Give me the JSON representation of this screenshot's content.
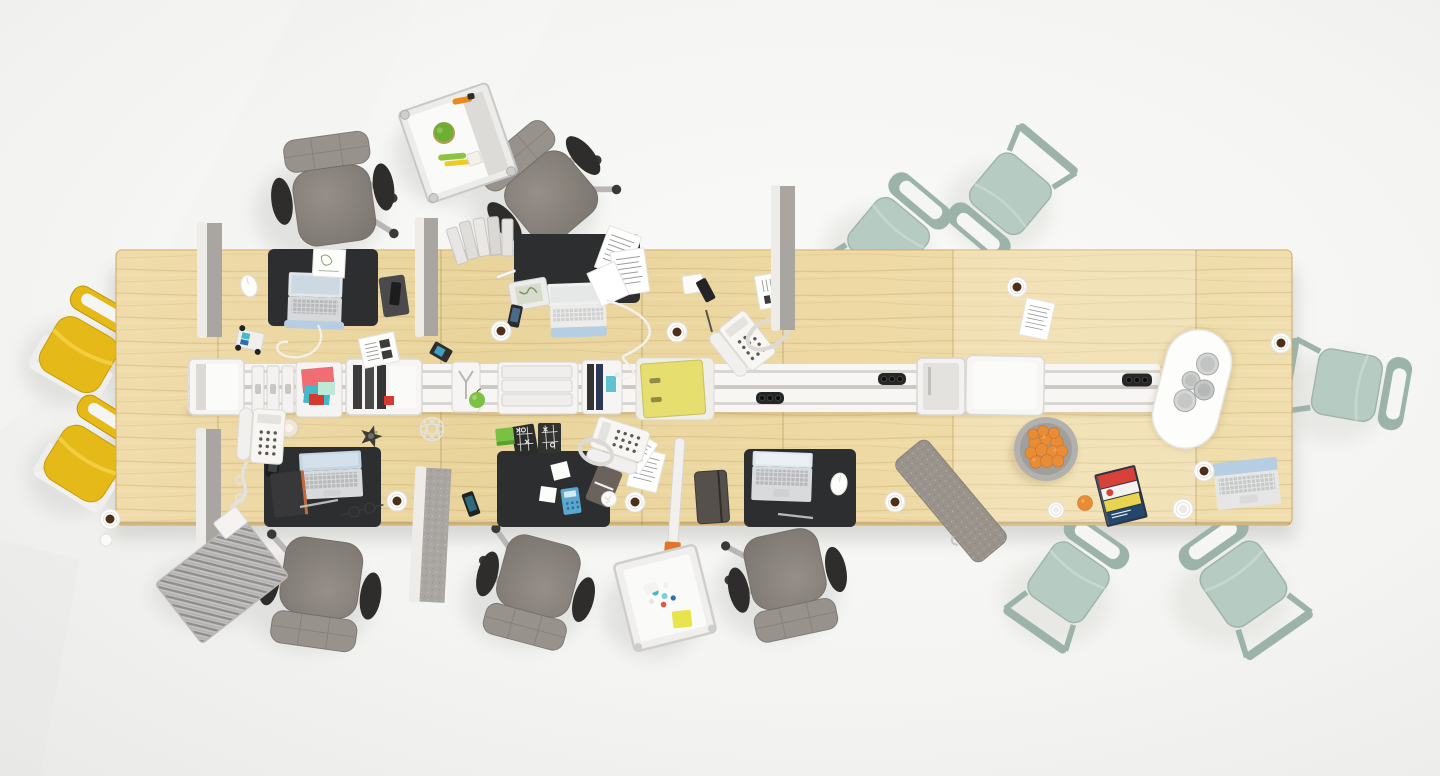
{
  "scene": {
    "description": "Top-down 3D render of a long shared office bench desk in light wood with a white central cable rail, black desk pads with open laptops, scattered papers, coffee cups, desk phones and accessories; gray task chairs, mint stacking chairs and yellow cantilever chairs stand around the desk on a white studio floor",
    "desk": {
      "label": "wood bench desk",
      "sections": 6,
      "seam_x_positions": [
        218,
        441,
        642,
        783,
        953,
        1196
      ]
    },
    "cable_rail": {
      "label": "white center cable rail",
      "power_strips": 3,
      "sockets_per_strip": 3
    },
    "desk_pads": {
      "label": "black desk pad",
      "count": 5
    },
    "laptops": {
      "label": "open laptop",
      "count": 5
    },
    "desk_phones": {
      "label": "white desk phone with coiled cord",
      "count": 3
    },
    "chairs": {
      "gray_task_chairs": 5,
      "mint_stacking_chairs": 5,
      "yellow_cantilever_chairs": 2
    },
    "dividers": {
      "label": "gray screen divider",
      "count": 5
    },
    "trolleys": {
      "label": "white utility trolley",
      "count": 2
    },
    "storage": [
      "open storage bin",
      "white ring binders",
      "paper tray with colorful sheets",
      "storage box with dark books",
      "wire organizer bin",
      "flat binder tray",
      "book box",
      "yellow lever-arch folder on tray",
      "right storage bins"
    ],
    "accessories": [
      "fruit bowl with oranges",
      "single clementine",
      "magazine stack",
      "white oval tray with glasses",
      "felt screen panel lying on desk",
      "striped mat",
      "leaning silver binders",
      "tic-tac-toe game",
      "green note block",
      "star ornament",
      "wire ball",
      "tape roll",
      "green apples",
      "eyeglasses",
      "toy truck",
      "voice recorder on notebook",
      "navigation device",
      "smartphones",
      "notebooks",
      "computer mice",
      "earbud cable",
      "paper sheets",
      "crumpled paper"
    ],
    "counts": {
      "coffee_cups": 9,
      "extra_cups": 2,
      "oranges_in_bowl": 13,
      "drinking_glasses": 4,
      "leaning_binders": 5
    }
  },
  "palette": {
    "floor": "#f5f5f3",
    "floor_dark": "#e9e9e7",
    "shadow": "#d7d6d3",
    "wood": "#ecd8a1",
    "wood_light": "#f3e3b4",
    "wood_line": "#b98f4a",
    "pad": "#2d2e30",
    "white": "#f7f6f4",
    "rail_line": "#d8d6d2",
    "silver": "#d6d7d7",
    "key": "#c6c8c9",
    "screen_blue": "#b6cee3",
    "chair_gray": "#8a8580",
    "chair_gray_light": "#97928c",
    "chair_dark": "#2e2d2c",
    "chrome": "#b9b7b5",
    "mint": "#b6cbc2",
    "mint_dark": "#9cb3aa",
    "yellow": "#e5b917",
    "yellow_dark": "#c79d0b",
    "divider": "#a9a5a1",
    "divider_light": "#eeece9",
    "felt": "#9a938b",
    "orange": "#e88d36",
    "folder": "#e6de6f",
    "coffee": "#4e2f17",
    "green": "#79c043",
    "red": "#d63a2e",
    "teal": "#45b9c6",
    "sticky": "#e9e34c"
  }
}
